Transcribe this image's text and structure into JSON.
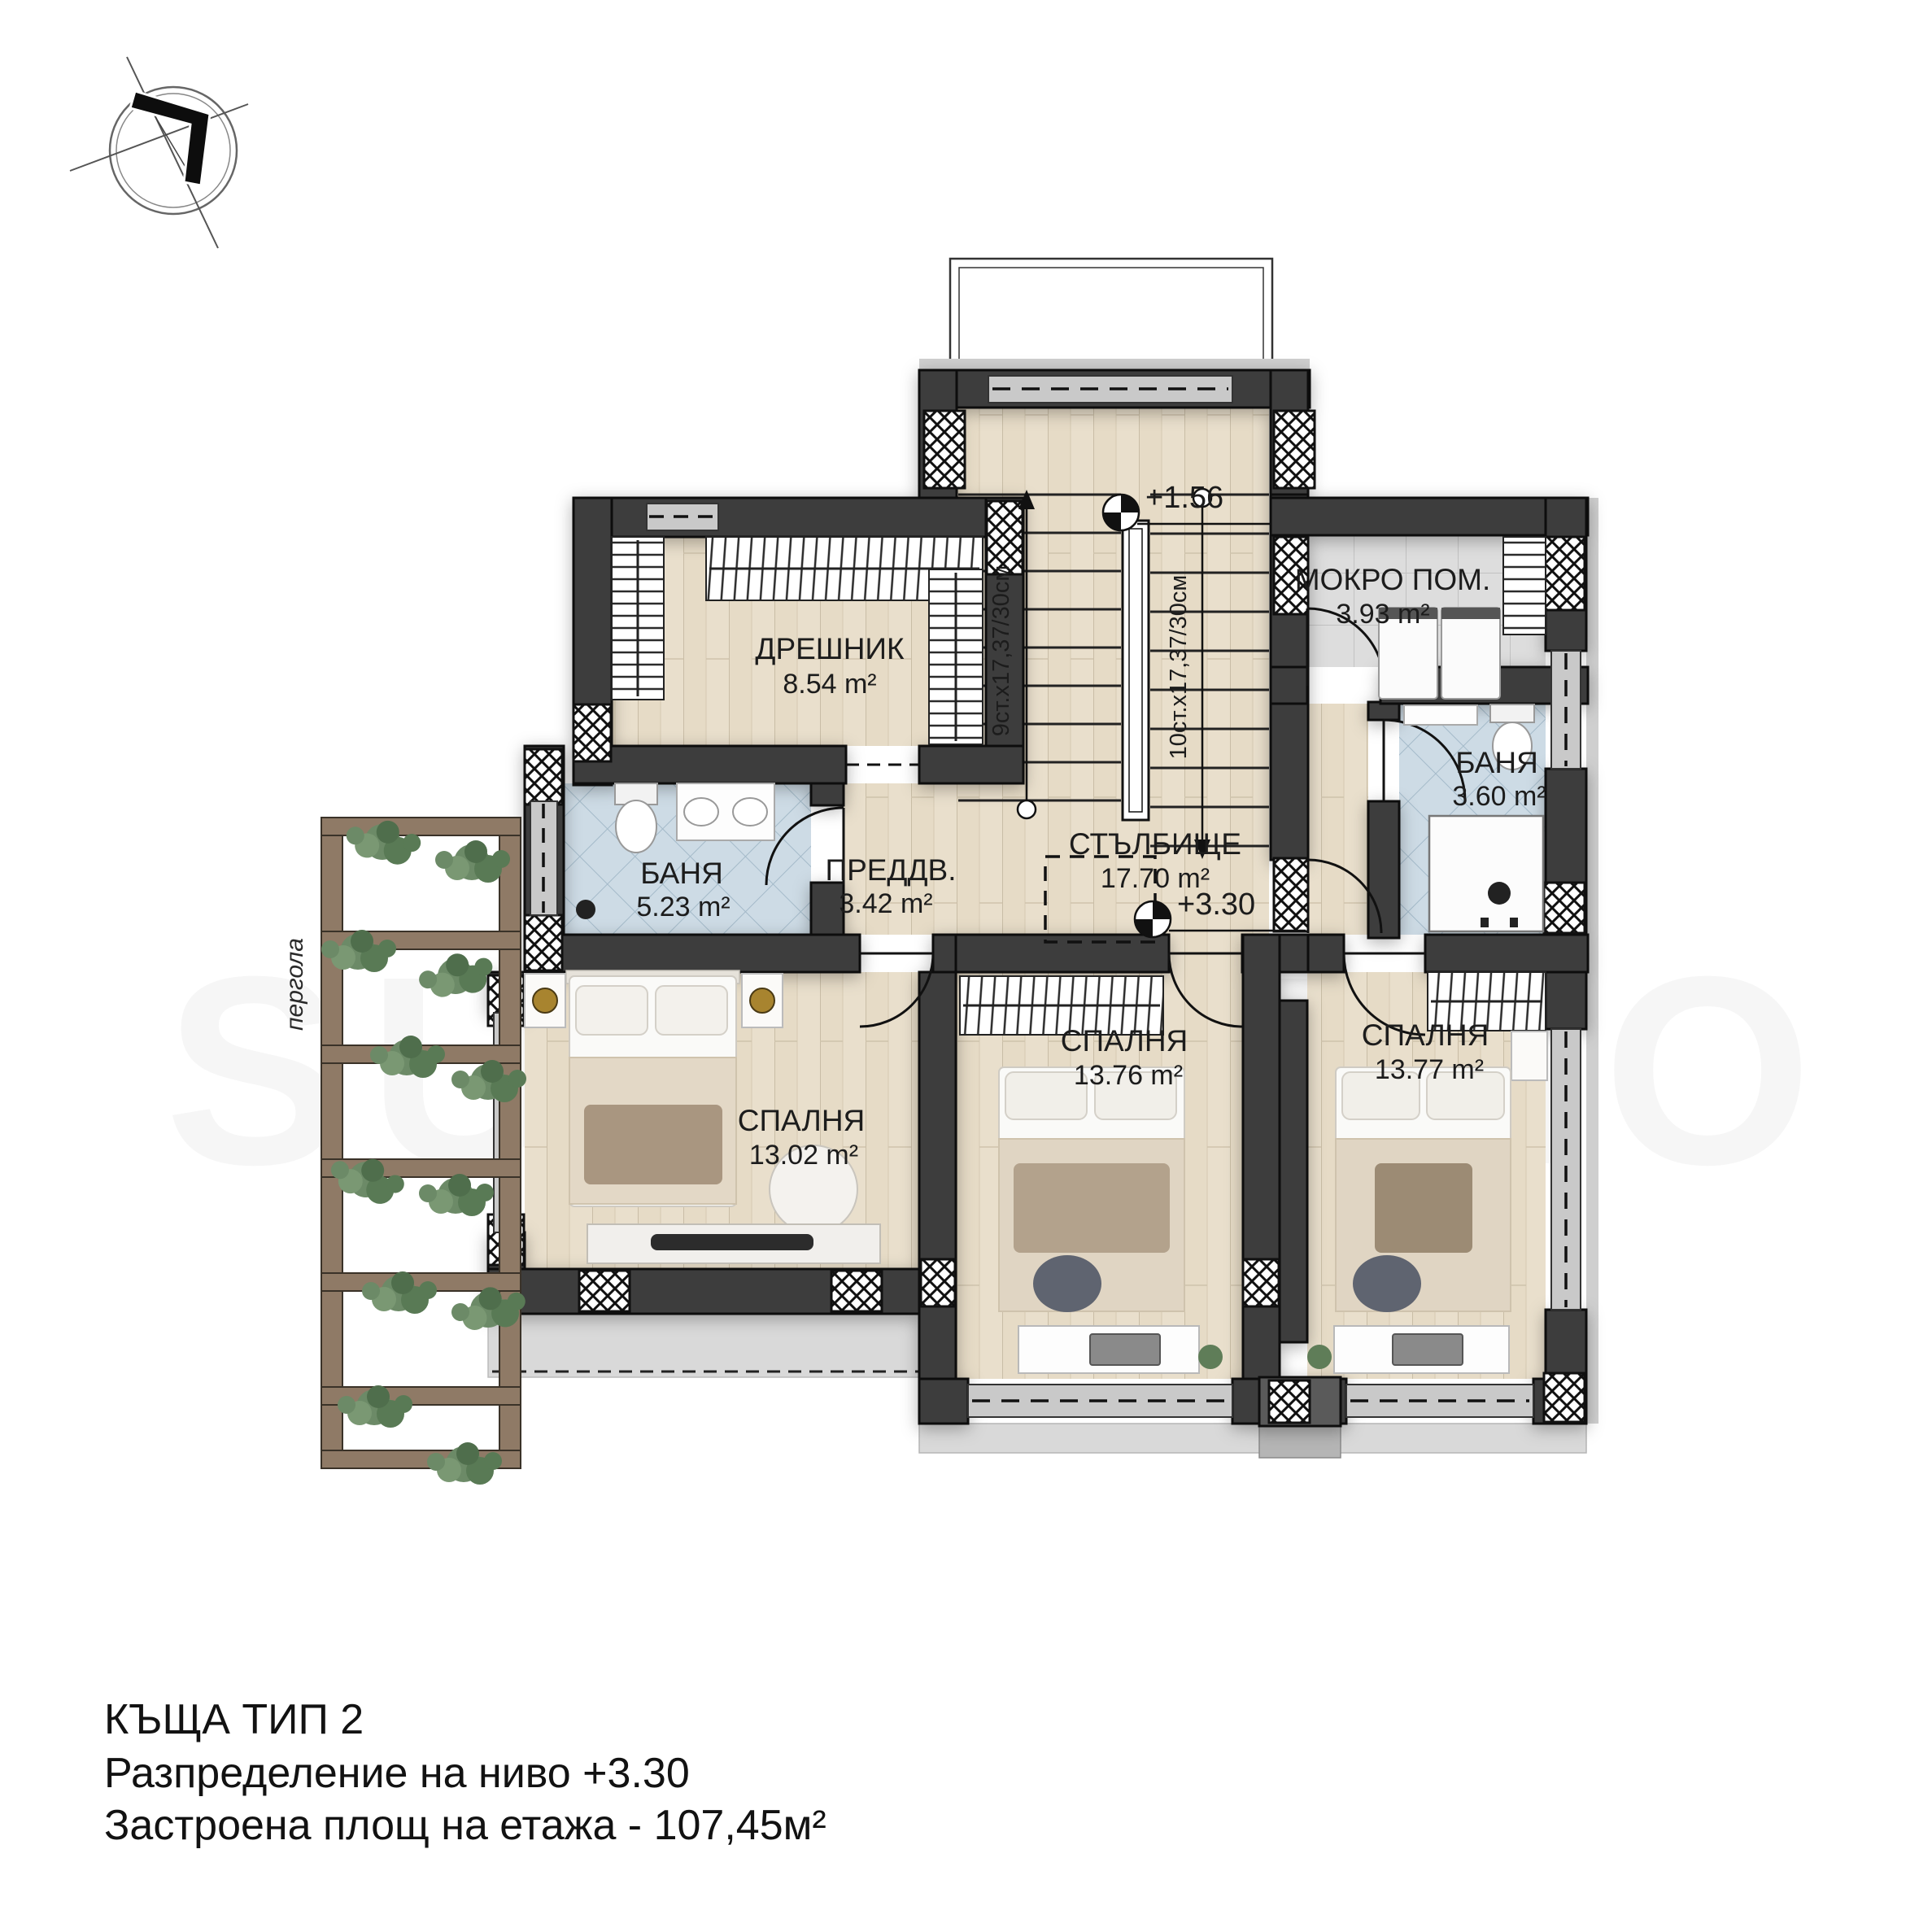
{
  "title_block": {
    "line1": "КЪЩА ТИП 2",
    "line2": "Разпределение на ниво +3.30",
    "line3": "Застроена площ на етажа - 107,45м²"
  },
  "rooms": {
    "dreshnik": {
      "name": "ДРЕШНИК",
      "area": "8.54 m²"
    },
    "mokro": {
      "name": "МОКРО ПОМ.",
      "area": "3.93 m²"
    },
    "banya_right": {
      "name": "БАНЯ",
      "area": "3.60 m²"
    },
    "banya_left": {
      "name": "БАНЯ",
      "area": "5.23 m²"
    },
    "preddverie": {
      "name": "ПРЕДДВ.",
      "area": "3.42 m²"
    },
    "stalbishte": {
      "name": "СТЪЛБИЩЕ",
      "area": "17.70 m²"
    },
    "bedroom_left": {
      "name": "СПАЛНЯ",
      "area": "13.02 m²"
    },
    "bedroom_mid": {
      "name": "СПАЛНЯ",
      "area": "13.76 m²"
    },
    "bedroom_right": {
      "name": "СПАЛНЯ",
      "area": "13.77 m²"
    }
  },
  "annotations": {
    "level_stairs": "+1.56",
    "level_floor": "+3.30",
    "stair_flight_up": "9ст.х17,37/30см",
    "stair_flight_down": "10ст.х17,37/30см",
    "pergola": "пергола",
    "watermark": "SUPRIMMO"
  },
  "colors": {
    "wall": "#3e3e3e",
    "floor_wood": "#e9dfcc",
    "tile_blue": "#cddbe5",
    "tile_gray": "#dddddd",
    "pergola_wood": "#8f7a66",
    "plant_green": "#5f7d58",
    "lamp_gold": "#a8842f",
    "terrace_gray": "#d9d9d9"
  }
}
